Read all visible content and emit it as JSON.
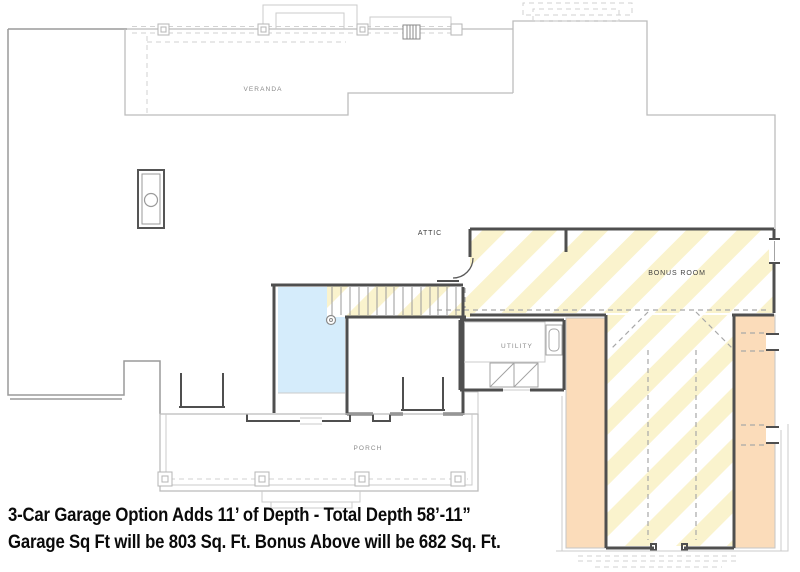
{
  "plan": {
    "labels": {
      "veranda": "VERANDA",
      "attic": "ATTIC",
      "bonus_room": "BONUS ROOM",
      "utility": "UTILITY",
      "porch": "PORCH"
    },
    "caption": {
      "line1": "3-Car Garage Option Adds 11’ of Depth - Total Depth 58’-11”",
      "line2": "Garage Sq Ft will be 803 Sq. Ft. Bonus Above will be 682 Sq. Ft."
    }
  },
  "colors": {
    "bonus_hatch": "#faf3cd",
    "garage_wall": "#fbdcba",
    "open_below": "#d5ecfb",
    "wall": "#4f4f4f",
    "roof_line": "#bcbcbc",
    "label_text": "#8a8a8a",
    "label_text_dark": "#3f3f3f",
    "caption_text": "#0a0a0a"
  }
}
